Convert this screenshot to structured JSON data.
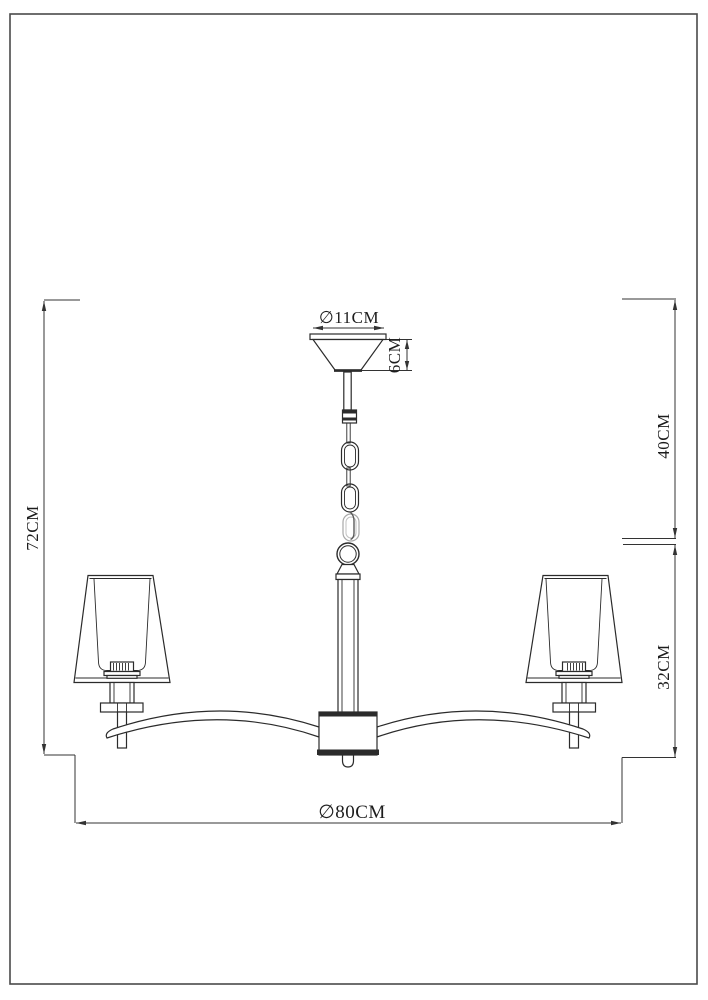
{
  "diagram": {
    "type": "technical-dimension-drawing",
    "subject": "chandelier line drawing, front elevation",
    "dimensions": {
      "canopy_diameter": "∅11CM",
      "canopy_height": "6CM",
      "suspension_length": "40CM",
      "body_height": "32CM",
      "overall_height": "72CM",
      "overall_diameter": "∅80CM"
    },
    "line_color": "#2b2b2b",
    "background_color": "#ffffff"
  }
}
